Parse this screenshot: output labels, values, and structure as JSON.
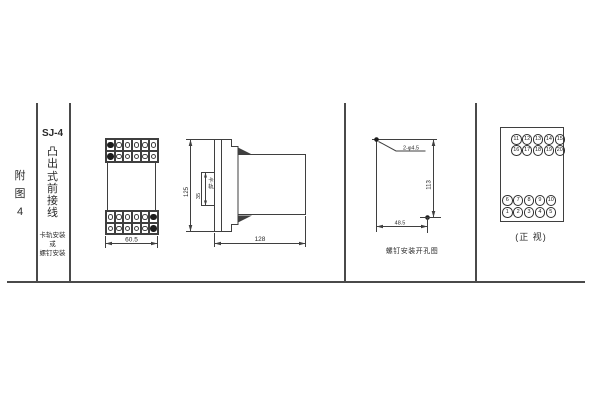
{
  "page": {
    "background": "#ffffff",
    "line_color": "#4a4a4a"
  },
  "title_block": {
    "figure_label": "附\n图\n4",
    "model": "SJ-4",
    "type_label": "凸\n出\n式\n前\n接\n线",
    "mount_note": "卡轨安装\n或\n螺钉安装"
  },
  "front_view": {
    "width_dim": "60.5"
  },
  "side_view": {
    "height_dim": "125",
    "rail_width_dim": "35",
    "rail_label": "卡轨",
    "depth_dim": "128"
  },
  "drill_view": {
    "holes_label": "2-φ4.5",
    "height_dim": "113",
    "width_dim": "48.5",
    "caption": "螺钉安装开孔图"
  },
  "terminal_view": {
    "caption": "(正 视)",
    "top_row1": [
      "11",
      "12",
      "13",
      "14",
      "15"
    ],
    "top_row2": [
      "16",
      "17",
      "18",
      "19",
      "20"
    ],
    "bottom_row1": [
      "6",
      "7",
      "8",
      "9",
      "10"
    ],
    "bottom_row2": [
      "1",
      "2",
      "3",
      "4",
      "5"
    ]
  }
}
